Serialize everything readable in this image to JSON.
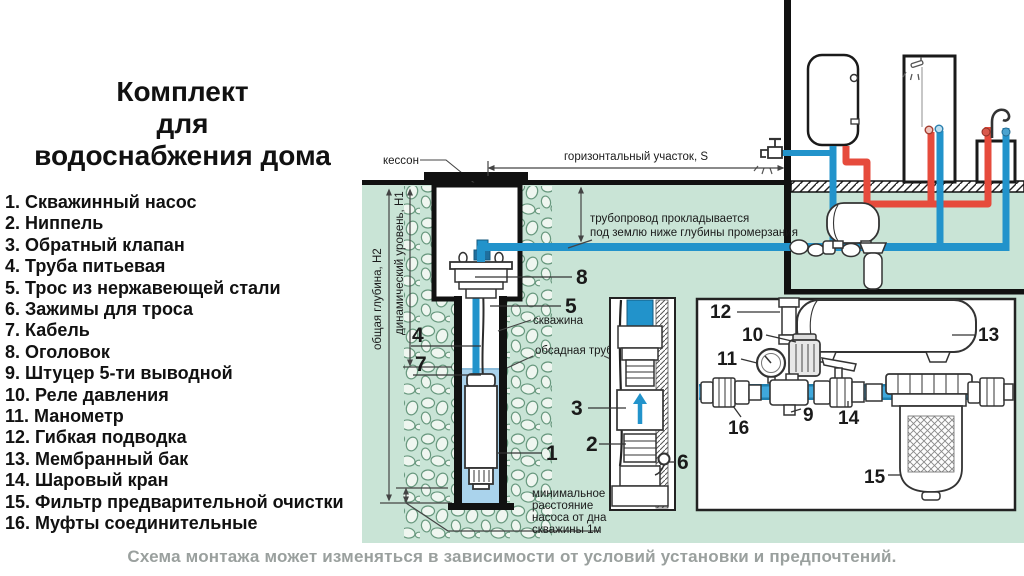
{
  "colors": {
    "ground_green": "#c9e4d6",
    "pipe_blue": "#2293cb",
    "pipe_red": "#e64b3c",
    "well_water": "#aad3ec",
    "line_black": "#1a1a1a",
    "caption_gray": "#9aa09e"
  },
  "title_lines": [
    "Комплект",
    "для",
    "водоснабжения дома"
  ],
  "legend": [
    "1. Скважинный насос",
    "2. Ниппель",
    "3. Обратный клапан",
    "4. Труба питьевая",
    "5. Трос из нержавеющей стали",
    "6. Зажимы для троса",
    "7. Кабель",
    "8. Оголовок",
    "9. Штуцер 5-ти выводной",
    "10. Реле давления",
    "11. Манометр",
    "12. Гибкая подводка",
    "13. Мембранный бак",
    "14. Шаровый кран",
    "15. Фильтр предварительной очистки",
    "16. Муфты соединительные"
  ],
  "caption": "Схема монтажа может изменяться в зависимости от условий установки и предпочтений.",
  "diagram": {
    "caisson": "кессон",
    "horizontal_section": "горизонтальный участок, S",
    "frost_l1": "трубопровод прокладывается",
    "frost_l2": "под землю ниже глубины промерзания",
    "borehole": "скважина",
    "casing_pipe": "обсадная труба",
    "min_l1": "минимальное",
    "min_l2": "расстояние",
    "min_l3": "насоса от дна",
    "min_l4": "скважины 1м",
    "total_depth": "общая глубина, Н2",
    "dynamic_level": "динамический уровень, Н1",
    "callouts": {
      "c1": "1",
      "c2": "2",
      "c3": "3",
      "c4": "4",
      "c5": "5",
      "c6": "6",
      "c7": "7",
      "c8": "8",
      "c9": "9",
      "c10": "10",
      "c11": "11",
      "c12": "12",
      "c13": "13",
      "c14": "14",
      "c15": "15",
      "c16": "16"
    }
  }
}
